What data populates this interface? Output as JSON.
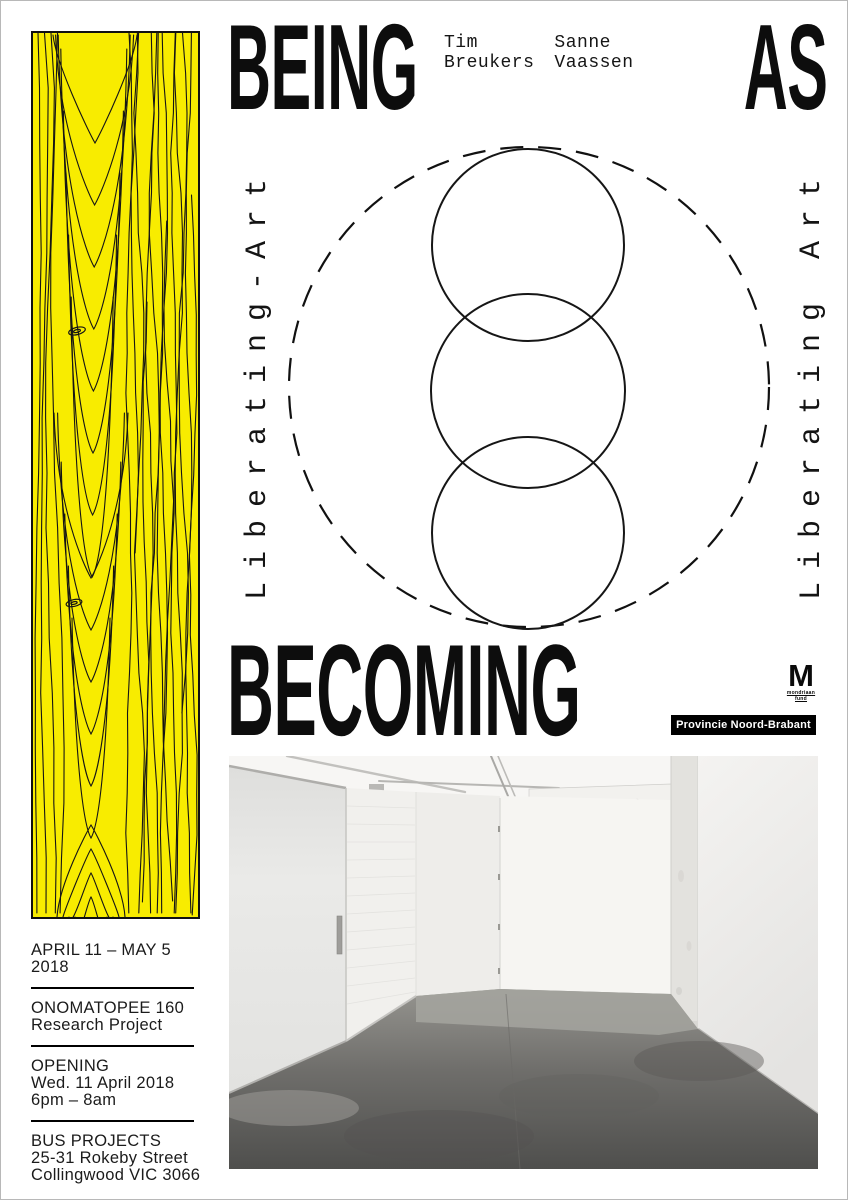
{
  "poster": {
    "headline": {
      "top_left": "BEING",
      "top_right": "AS",
      "bottom": "BECOMING"
    },
    "artists": [
      {
        "first_name": "Tim",
        "last_name": "Breukers"
      },
      {
        "first_name": "Sanne",
        "last_name": "Vaassen"
      }
    ],
    "vertical_text_left": "Liberating-Art",
    "vertical_text_right": "Liberating Art",
    "logos": {
      "mondriaan_letter": "M",
      "mondriaan_line1": "mondriaan",
      "mondriaan_line2": "fund",
      "provincie_badge": "Provincie Noord-Brabant"
    },
    "event_details": {
      "dates": "APRIL 11 – MAY 5 2018",
      "project_line1": "ONOMATOPEE 160",
      "project_line2": "Research Project",
      "opening_heading": "OPENING",
      "opening_date": "Wed. 11 April 2018",
      "opening_time": "6pm – 8am",
      "venue_name": "BUS PROJECTS",
      "venue_address1": "25-31 Rokeby Street",
      "venue_address2": "Collingwood VIC 3066"
    },
    "colors": {
      "wood_yellow": "#f8ec00",
      "ink": "#111111",
      "badge_background": "#000000",
      "badge_text": "#ffffff"
    }
  }
}
